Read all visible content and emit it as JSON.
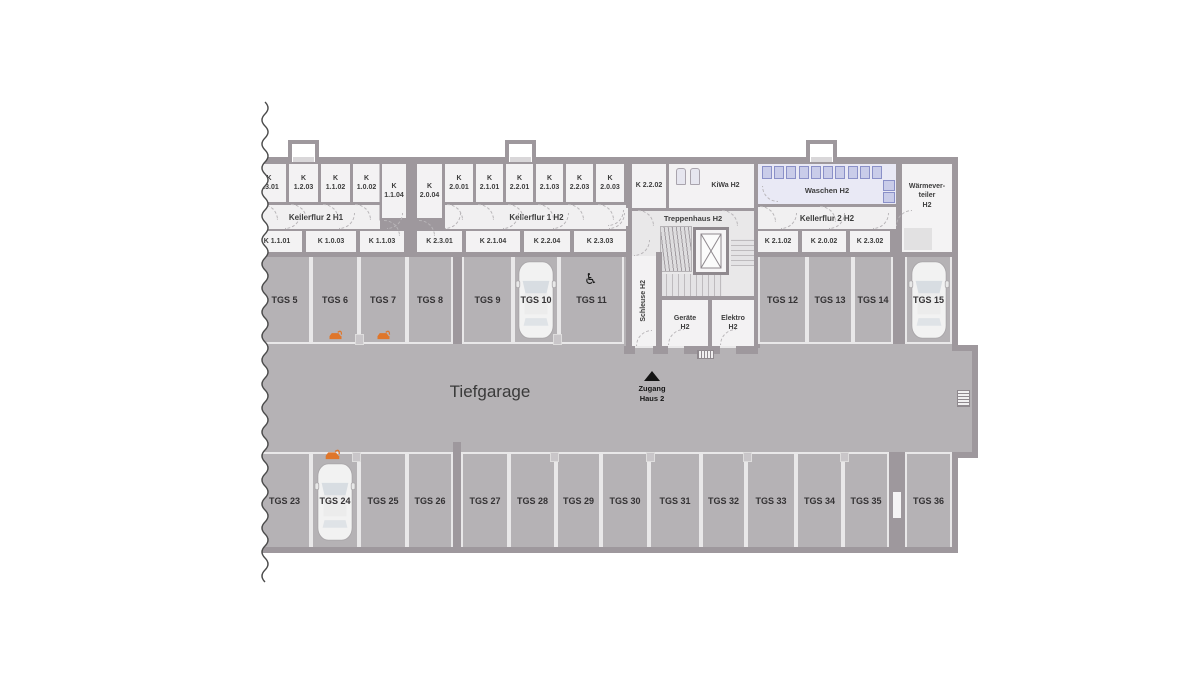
{
  "colors": {
    "wall": "#9e989d",
    "garage_floor": "#b5b2b5",
    "room_fill": "#f3f2f3",
    "divider_line": "#e9e8e9",
    "waschen_fill": "#e9e9f5",
    "machine_fill": "#c9cce9",
    "ev_orange": "#e0762a",
    "text": "#3d3d3d"
  },
  "garage": {
    "label": "Tiefgarage",
    "entrance_label": "Zugang\nHaus 2",
    "top_row": [
      "TGS 5",
      "TGS 6",
      "TGS 7",
      "TGS 8",
      "TGS 9",
      "TGS 10",
      "TGS 11",
      "TGS 12",
      "TGS 13",
      "TGS 14",
      "TGS 15"
    ],
    "bottom_row": [
      "TGS 23",
      "TGS 24",
      "TGS 25",
      "TGS 26",
      "TGS 27",
      "TGS 28",
      "TGS 29",
      "TGS 30",
      "TGS 31",
      "TGS 32",
      "TGS 33",
      "TGS 34",
      "TGS 35",
      "TGS 36"
    ],
    "ev_charging_spots": [
      "TGS 6",
      "TGS 7",
      "TGS 24"
    ],
    "accessible_spot": "TGS 11",
    "occupied_spots": [
      "TGS 10",
      "TGS 15",
      "TGS 24"
    ],
    "wheelchair_symbol": "♿"
  },
  "keller": {
    "section_h1": {
      "corridor": "Kellerflur 2 H1",
      "top_rooms": [
        "K\n1.3.01",
        "K\n1.2.03",
        "K\n1.1.02",
        "K\n1.0.02",
        "K\n1.1.04"
      ],
      "bottom_rooms": [
        "K 1.1.01",
        "K 1.0.03",
        "K 1.1.03"
      ]
    },
    "section_h2": {
      "corridor": "Kellerflur 1 H2",
      "top_rooms": [
        "K\n2.0.04",
        "K\n2.0.01",
        "K\n2.1.01",
        "K\n2.2.01",
        "K\n2.1.03",
        "K\n2.2.03",
        "K\n2.0.03"
      ],
      "bottom_rooms": [
        "K 2.3.01",
        "K 2.1.04",
        "K 2.2.04",
        "K 2.3.03"
      ]
    },
    "core": {
      "room": "K 2.2.02",
      "kiwa": "KiWa H2",
      "stairs": "Treppenhaus H2",
      "schleuse": "Schleuse H2",
      "geraete": "Geräte\nH2",
      "elektro": "Elektro\nH2"
    },
    "east": {
      "waschen": "Waschen H2",
      "corridor": "Kellerflur 2 H2",
      "bottom_rooms": [
        "K 2.1.02",
        "K 2.0.02",
        "K 2.3.02"
      ],
      "waerme": "Wärmever-\nteiler\nH2"
    }
  }
}
